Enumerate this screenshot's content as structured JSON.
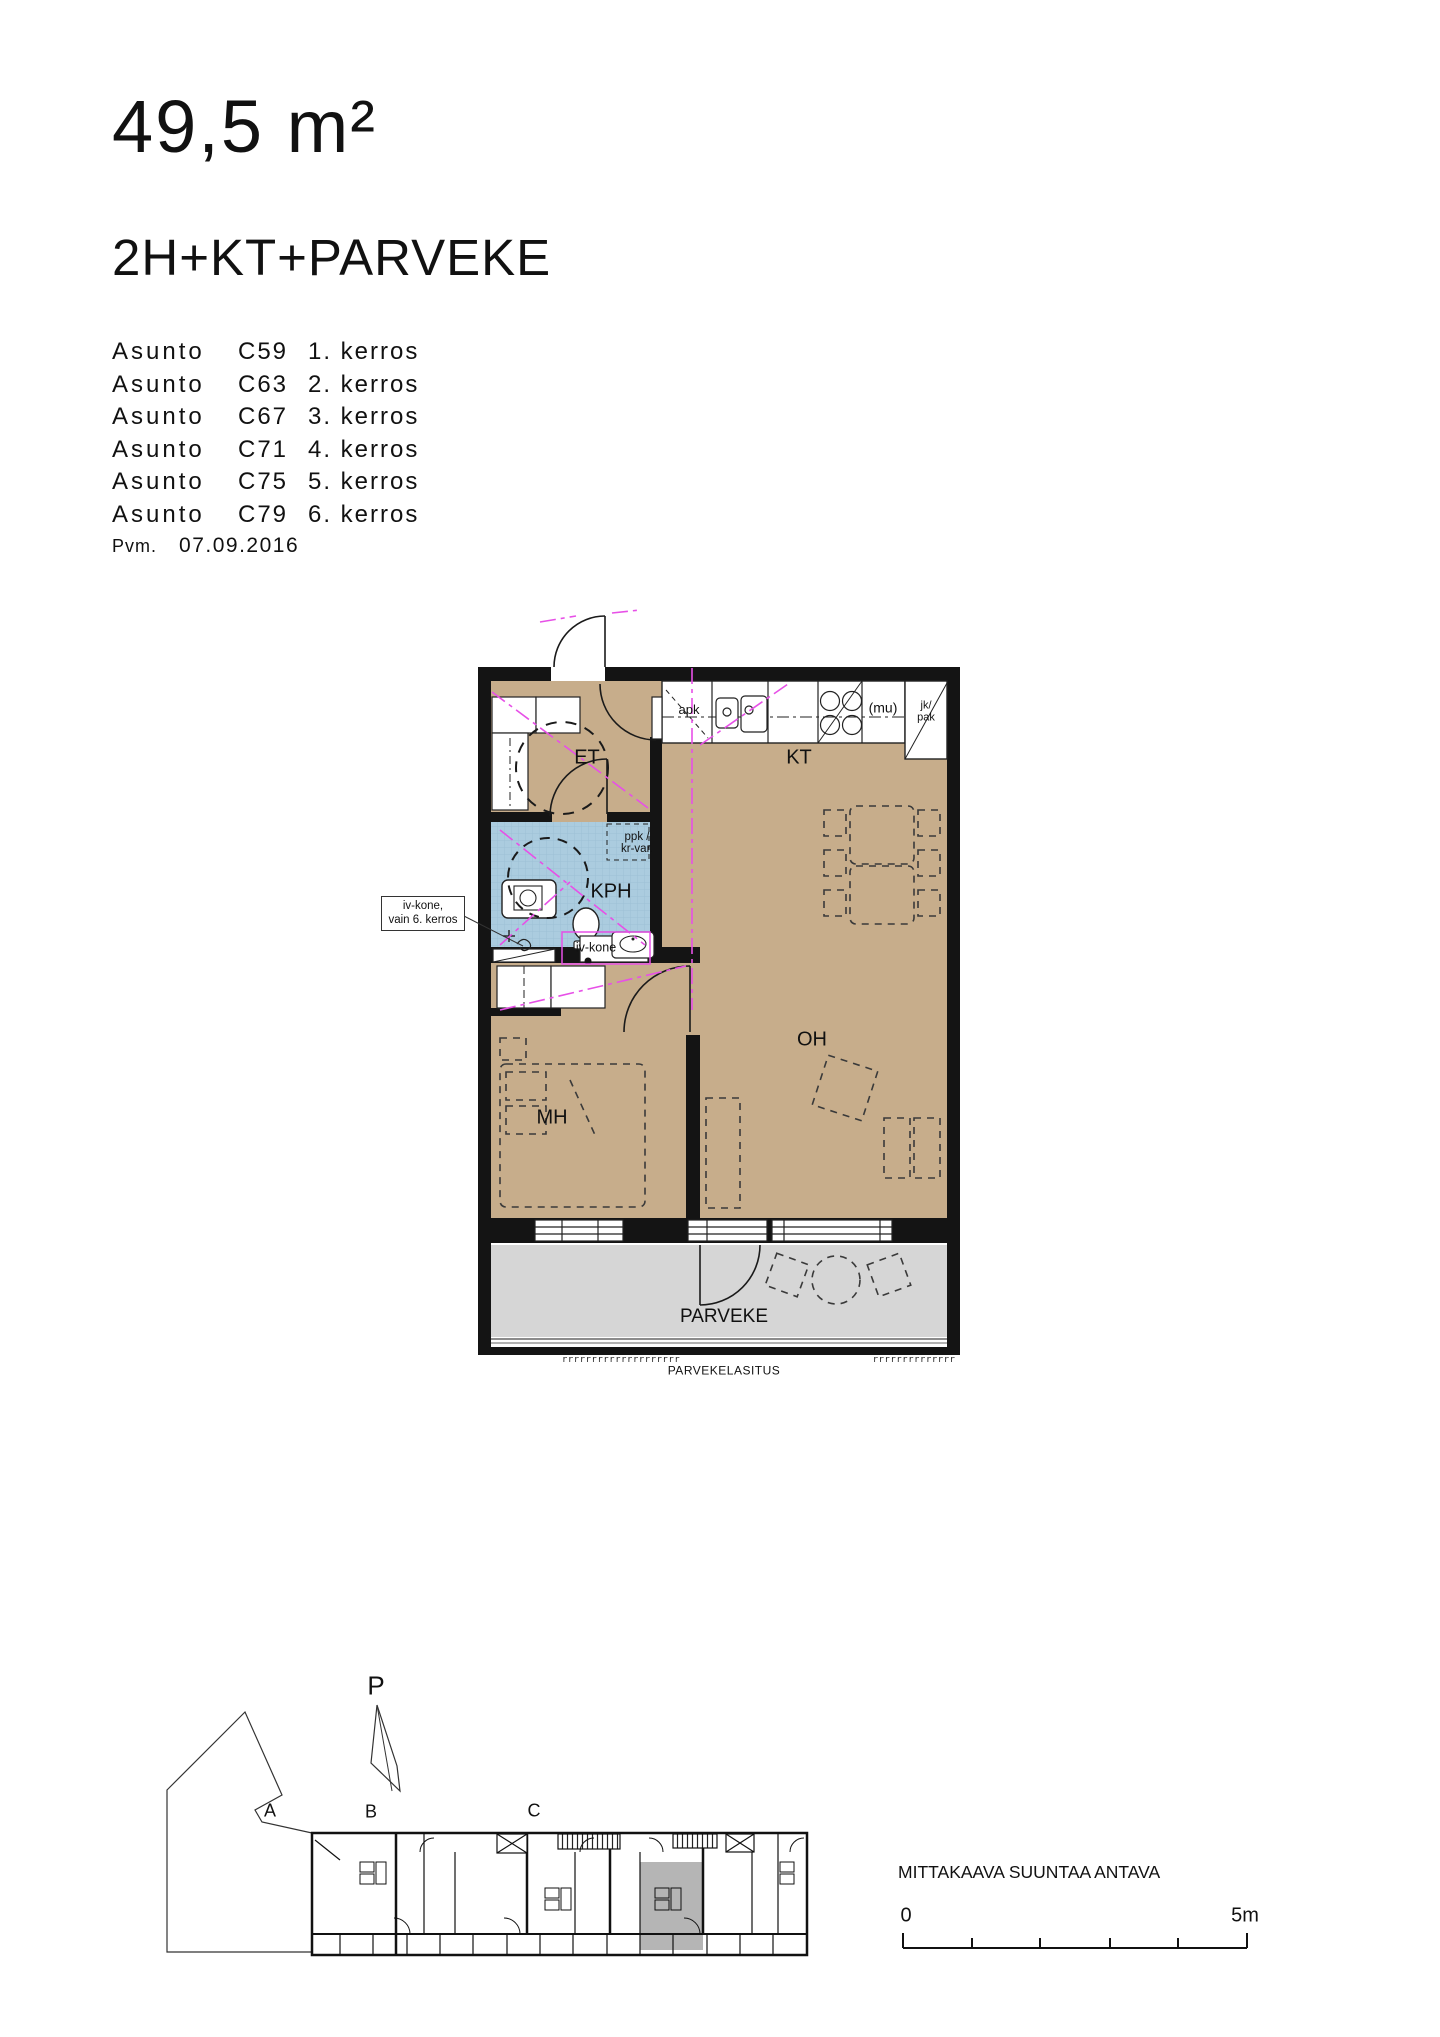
{
  "header": {
    "area": "49,5 m²",
    "layout": "2H+KT+PARVEKE"
  },
  "apartments": [
    {
      "label": "Asunto",
      "code": "C59",
      "floor": "1. kerros"
    },
    {
      "label": "Asunto",
      "code": "C63",
      "floor": "2. kerros"
    },
    {
      "label": "Asunto",
      "code": "C67",
      "floor": "3. kerros"
    },
    {
      "label": "Asunto",
      "code": "C71",
      "floor": "4. kerros"
    },
    {
      "label": "Asunto",
      "code": "C75",
      "floor": "5. kerros"
    },
    {
      "label": "Asunto",
      "code": "C79",
      "floor": "6. kerros"
    }
  ],
  "date": {
    "label": "Pvm.",
    "value": "07.09.2016"
  },
  "plan": {
    "rooms": {
      "et": "ET",
      "kt": "KT",
      "kph": "KPH",
      "mh": "MH",
      "oh": "OH",
      "parveke": "PARVEKE"
    },
    "fixtures": {
      "apk": "apk",
      "mu": "(mu)",
      "jk": "jk/",
      "pak": "pak",
      "ppk": "ppk /",
      "krvar": "kr-var.",
      "ivkone": "iv-kone"
    },
    "callout": {
      "line1": "iv-kone,",
      "line2": "vain 6. kerros"
    },
    "glazing": {
      "label": "PARVEKELASITUS",
      "ticks_left": "rrrrrrrrrrrrrrrrrrrr",
      "ticks_right": "rrrrrrrrrrrrrr"
    }
  },
  "site": {
    "north": "P",
    "section_a": "A",
    "section_b": "B",
    "section_c": "C",
    "scale_note": "MITTAKAAVA SUUNTAA ANTAVA",
    "scale_start": "0",
    "scale_end": "5m"
  },
  "colors": {
    "floor_tan": "#c7ad8b",
    "bath_blue": "#abccdf",
    "balcony_gray": "#d6d6d6",
    "site_highlight": "#b5b5b5",
    "service_magenta": "#e750e7",
    "wall_black": "#141414"
  }
}
